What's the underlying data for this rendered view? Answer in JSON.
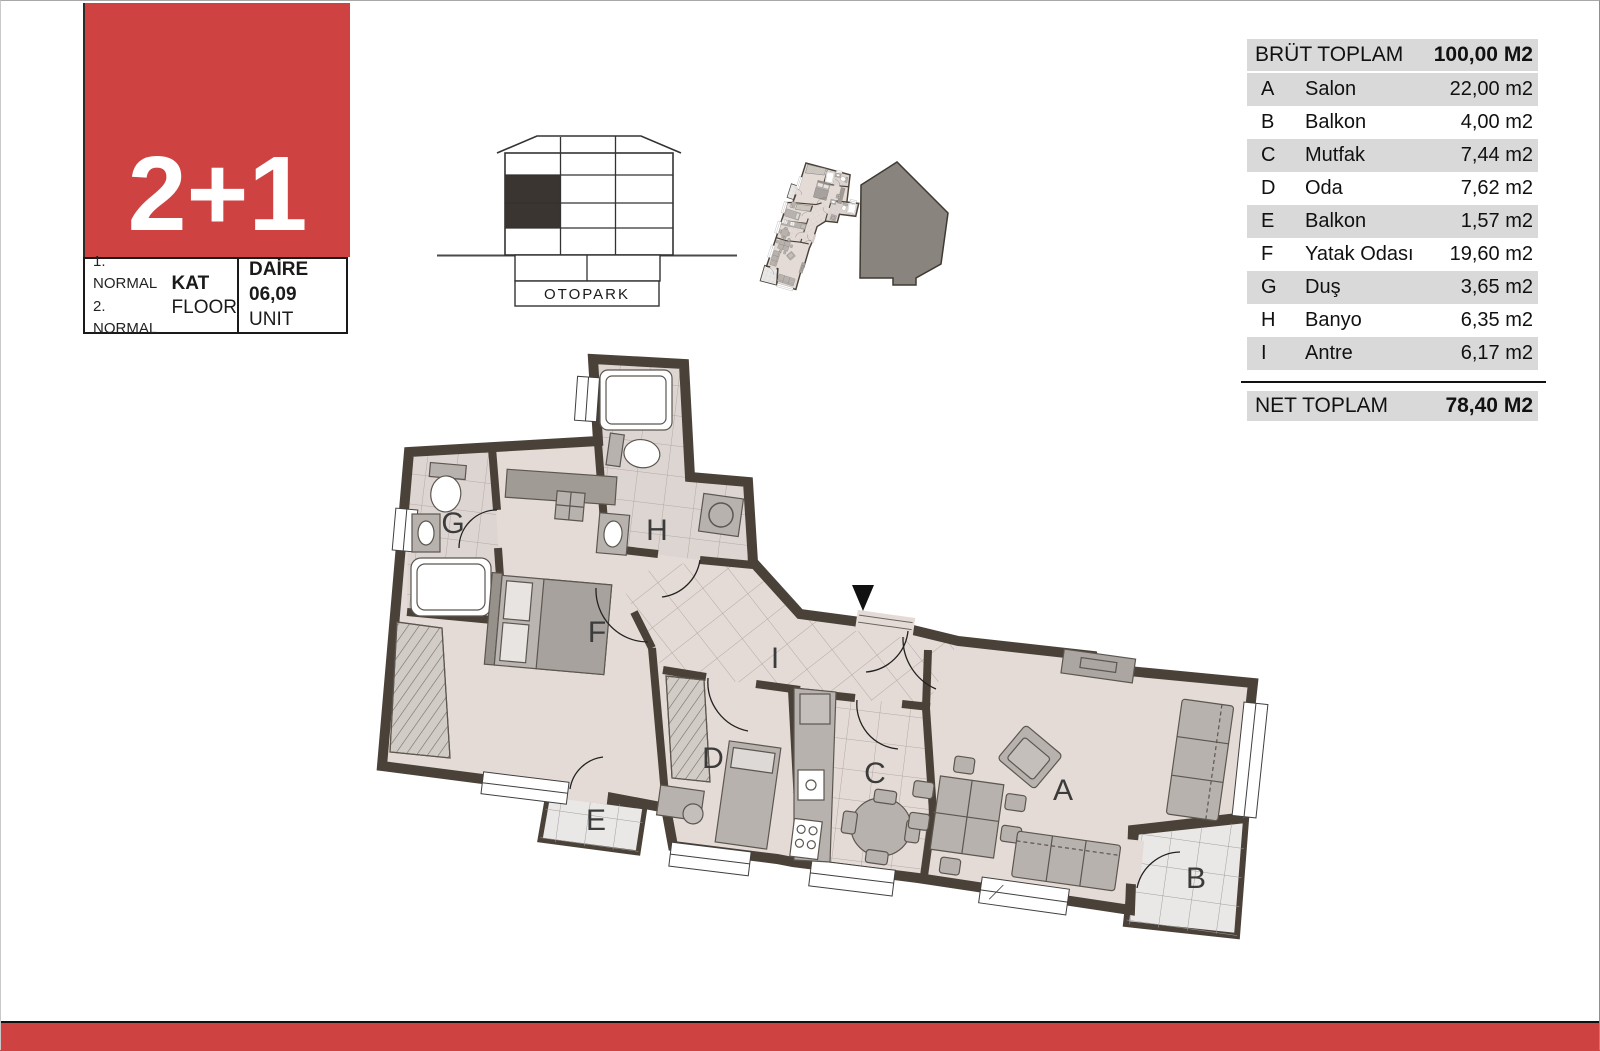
{
  "colors": {
    "accent_red": "#ce4242",
    "wall": "#4a4238",
    "floor": "#e4dbd6",
    "balcony_floor": "#eae8e6",
    "table_stripe": "#d9d9d9"
  },
  "title_block": {
    "type_label": "2+1",
    "floor_items": [
      "1. NORMAL",
      "2. NORMAL"
    ],
    "floor_title": "KAT",
    "floor_subtitle": "FLOOR",
    "unit_title": "DAİRE 06,09",
    "unit_subtitle": "UNIT"
  },
  "elevation": {
    "otopark_label": "OTOPARK"
  },
  "area_table": {
    "header": {
      "label": "BRÜT TOPLAM",
      "value": "100,00 M2"
    },
    "rows": [
      {
        "letter": "A",
        "name": "Salon",
        "area": "22,00 m2"
      },
      {
        "letter": "B",
        "name": "Balkon",
        "area": "4,00 m2"
      },
      {
        "letter": "C",
        "name": "Mutfak",
        "area": "7,44 m2"
      },
      {
        "letter": "D",
        "name": "Oda",
        "area": "7,62 m2"
      },
      {
        "letter": "E",
        "name": "Balkon",
        "area": "1,57 m2"
      },
      {
        "letter": "F",
        "name": "Yatak Odası",
        "area": "19,60 m2"
      },
      {
        "letter": "G",
        "name": "Duş",
        "area": "3,65 m2"
      },
      {
        "letter": "H",
        "name": "Banyo",
        "area": "6,35 m2"
      },
      {
        "letter": "I",
        "name": "Antre",
        "area": "6,17 m2"
      }
    ],
    "footer": {
      "label": "NET TOPLAM",
      "value": "78,40 M2"
    }
  },
  "plan": {
    "labels": {
      "A": "A",
      "B": "B",
      "C": "C",
      "D": "D",
      "E": "E",
      "F": "F",
      "G": "G",
      "H": "H",
      "I": "I"
    }
  }
}
